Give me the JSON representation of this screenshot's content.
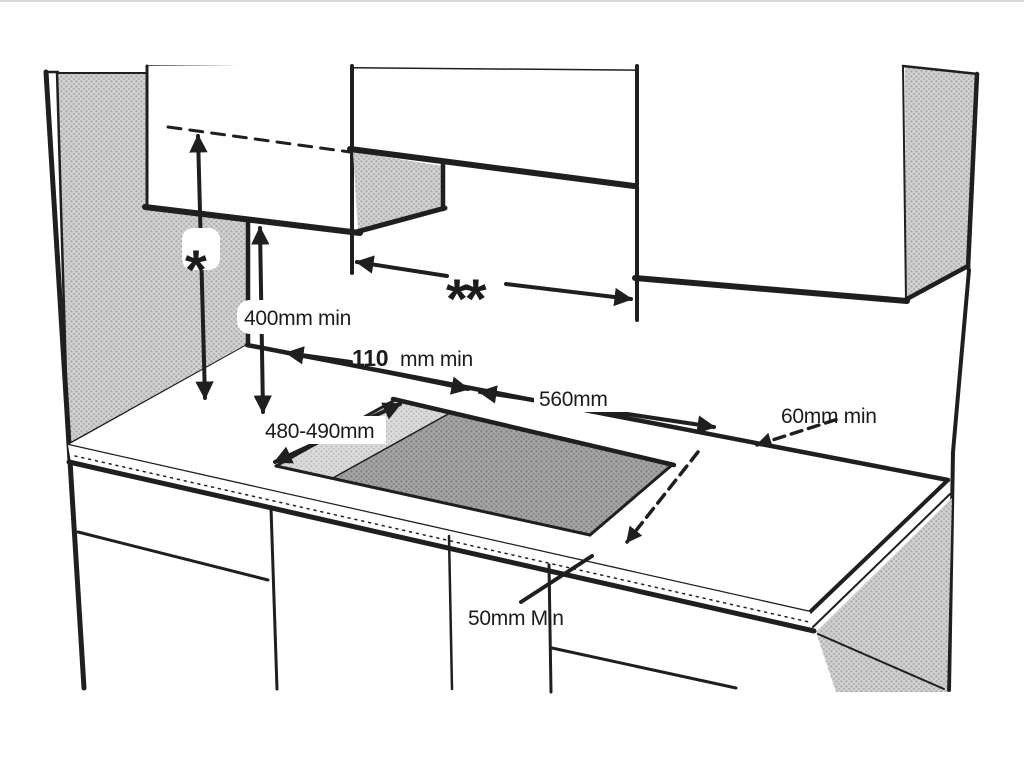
{
  "diagram": {
    "annotations": {
      "star": "*",
      "double_star": "**",
      "hood_min_height": "400mm min",
      "rear_clearance_value": "110",
      "rear_clearance_unit": "mm min",
      "cutout_width": "560mm",
      "cutout_depth": "480-490mm",
      "side_clearance_min": "60mm min",
      "front_clearance_min": "50mm Min"
    },
    "colors": {
      "line": "#1f1f1f",
      "hatch_mid": "#d2d2d2",
      "hatch_dark": "#a6a6a6",
      "background": "#ffffff"
    }
  }
}
